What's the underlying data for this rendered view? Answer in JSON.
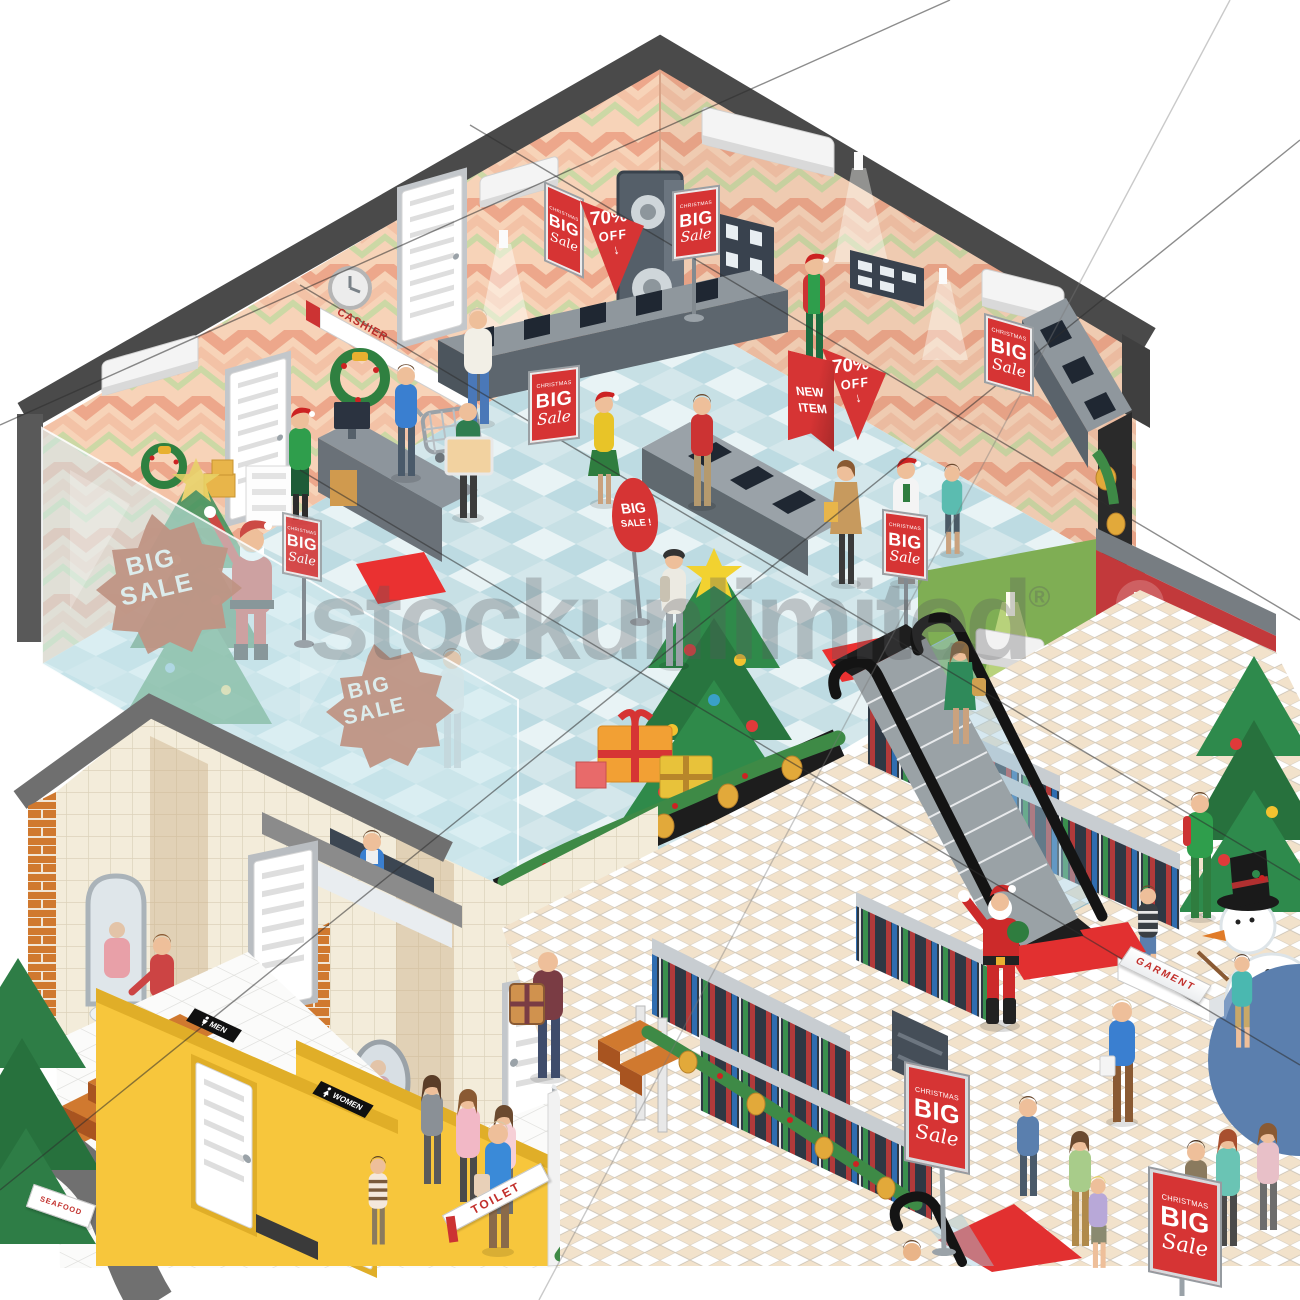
{
  "illustration": {
    "title": "Christmas big sale at a shopping mall - isometric cutaway",
    "watermark": {
      "text": "stockunlimited",
      "registered": "®"
    },
    "upper_floor": {
      "cashier_sign": "CASHIER",
      "poster": {
        "header": "CHRISTMAS",
        "big": "BIG",
        "sale": "Sale"
      },
      "discount_banner": {
        "percent": "70%",
        "off": "OFF",
        "arrow": "↓"
      },
      "new_item_banner": {
        "line1": "NEW",
        "line2": "ITEM"
      },
      "sale_tag": {
        "line1": "BIG",
        "line2": "SALE !"
      },
      "window_sticker": {
        "line1": "BIG",
        "line2": "SALE"
      }
    },
    "ground_floor": {
      "men_sign": "MEN",
      "women_sign": "WOMEN",
      "toilet_sign": "TOILET",
      "seafood_sign": "SEAFOOD",
      "garment_sign": "GARMENT"
    },
    "colors": {
      "sale_red": "#d63434",
      "wall_peach": "#f7d3b8",
      "wall_yellow": "#f7c63c",
      "wall_green": "#7fae54",
      "wall_red": "#c2393b",
      "floor_teal": "#cfe3e8",
      "roof_gray": "#4a4a4a",
      "sticker_brown": "#bf9484"
    }
  }
}
